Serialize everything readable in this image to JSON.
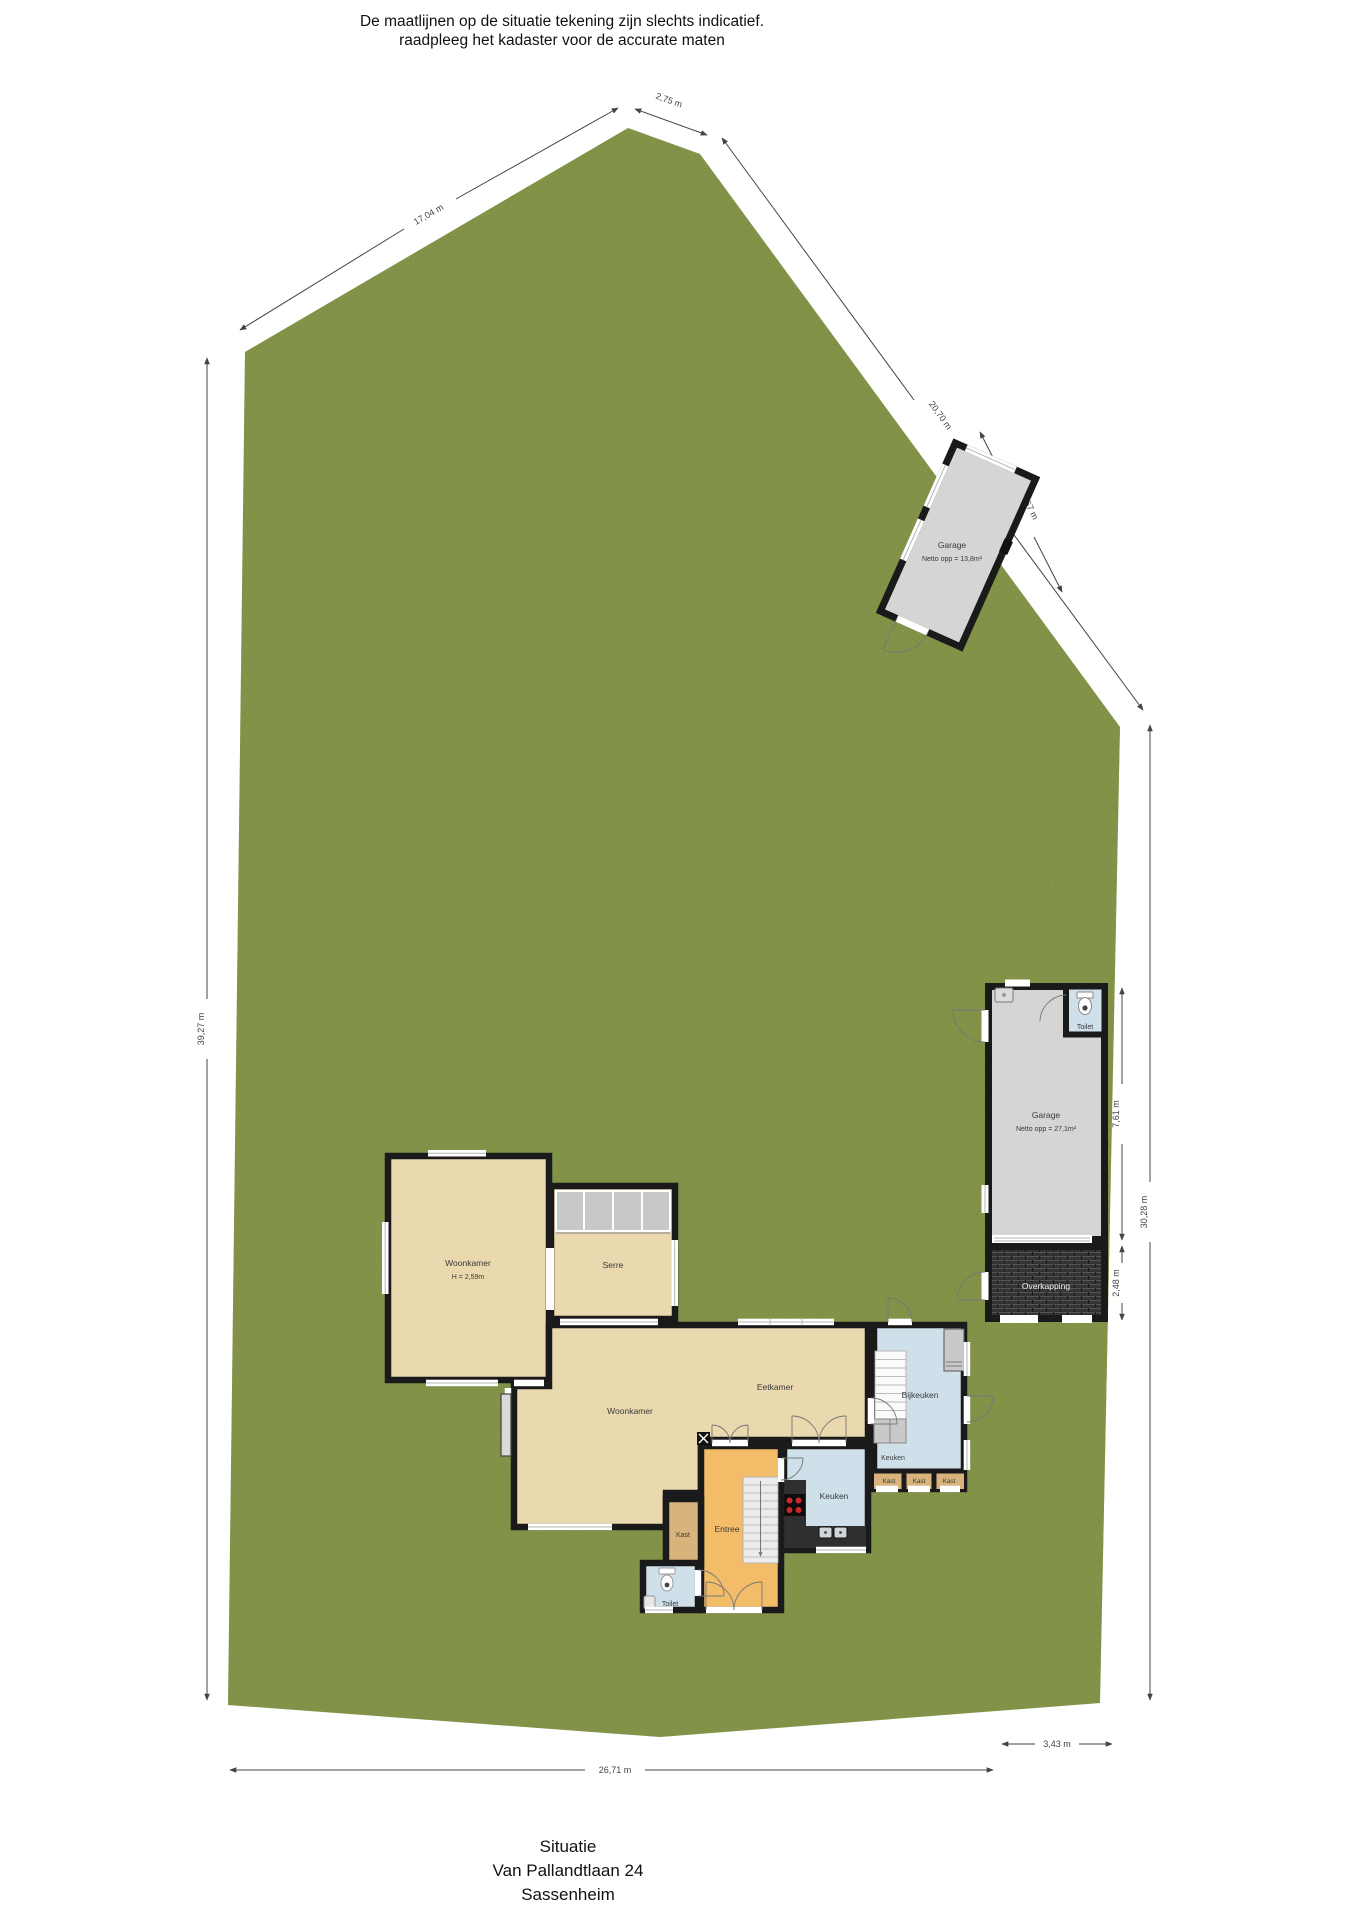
{
  "header": {
    "line1": "De maatlijnen op de situatie tekening zijn slechts indicatief.",
    "line2": "raadpleeg het kadaster voor de accurate maten"
  },
  "footer": {
    "title": "Situatie",
    "address": "Van Pallandtlaan 24",
    "city": "Sassenheim"
  },
  "plot": {
    "dimensions": {
      "top_edge": "17,04 m",
      "apex_edge": "2,75 m",
      "right_diagonal": "20,70 m",
      "garage_frontage": "5,67 m",
      "left_edge": "39,27 m",
      "right_edge": "30,28 m",
      "garage_depth": "7,61 m",
      "overkapping_depth": "2,48 m",
      "bottom_edge": "26,71 m",
      "bottom_right_edge": "3,43 m"
    },
    "colors": {
      "grass": "#7b8e41",
      "outside": "#ffffff",
      "wall": "#1a1a1a",
      "room_beige": "#ead8af",
      "room_orange": "#f2bc68",
      "room_blue": "#cfe0ea",
      "room_tan": "#d8b37c",
      "garage_gray": "#d5d5d5",
      "overkapping": "#333333"
    }
  },
  "detached_garage": {
    "name": "Garage",
    "area": "Netto opp = 13,8m²"
  },
  "attached_garage": {
    "name": "Garage",
    "area": "Netto opp = 27,1m²",
    "toilet": "Toilet",
    "overkapping": "Overkapping"
  },
  "house": {
    "woonkamer1": {
      "name": "Woonkamer",
      "ceiling": "H = 2,59m"
    },
    "serre": "Serre",
    "woonkamer2": "Woonkamer",
    "eetkamer": "Eetkamer",
    "bijkeuken": "Bijkeuken",
    "keuken1": "Keuken",
    "keuken2": "Keuken",
    "kast1": "Kast",
    "kast2": "Kast",
    "kast3": "Kast",
    "kast4": "Kast",
    "entree": "Entree",
    "toilet": "Toilet"
  }
}
